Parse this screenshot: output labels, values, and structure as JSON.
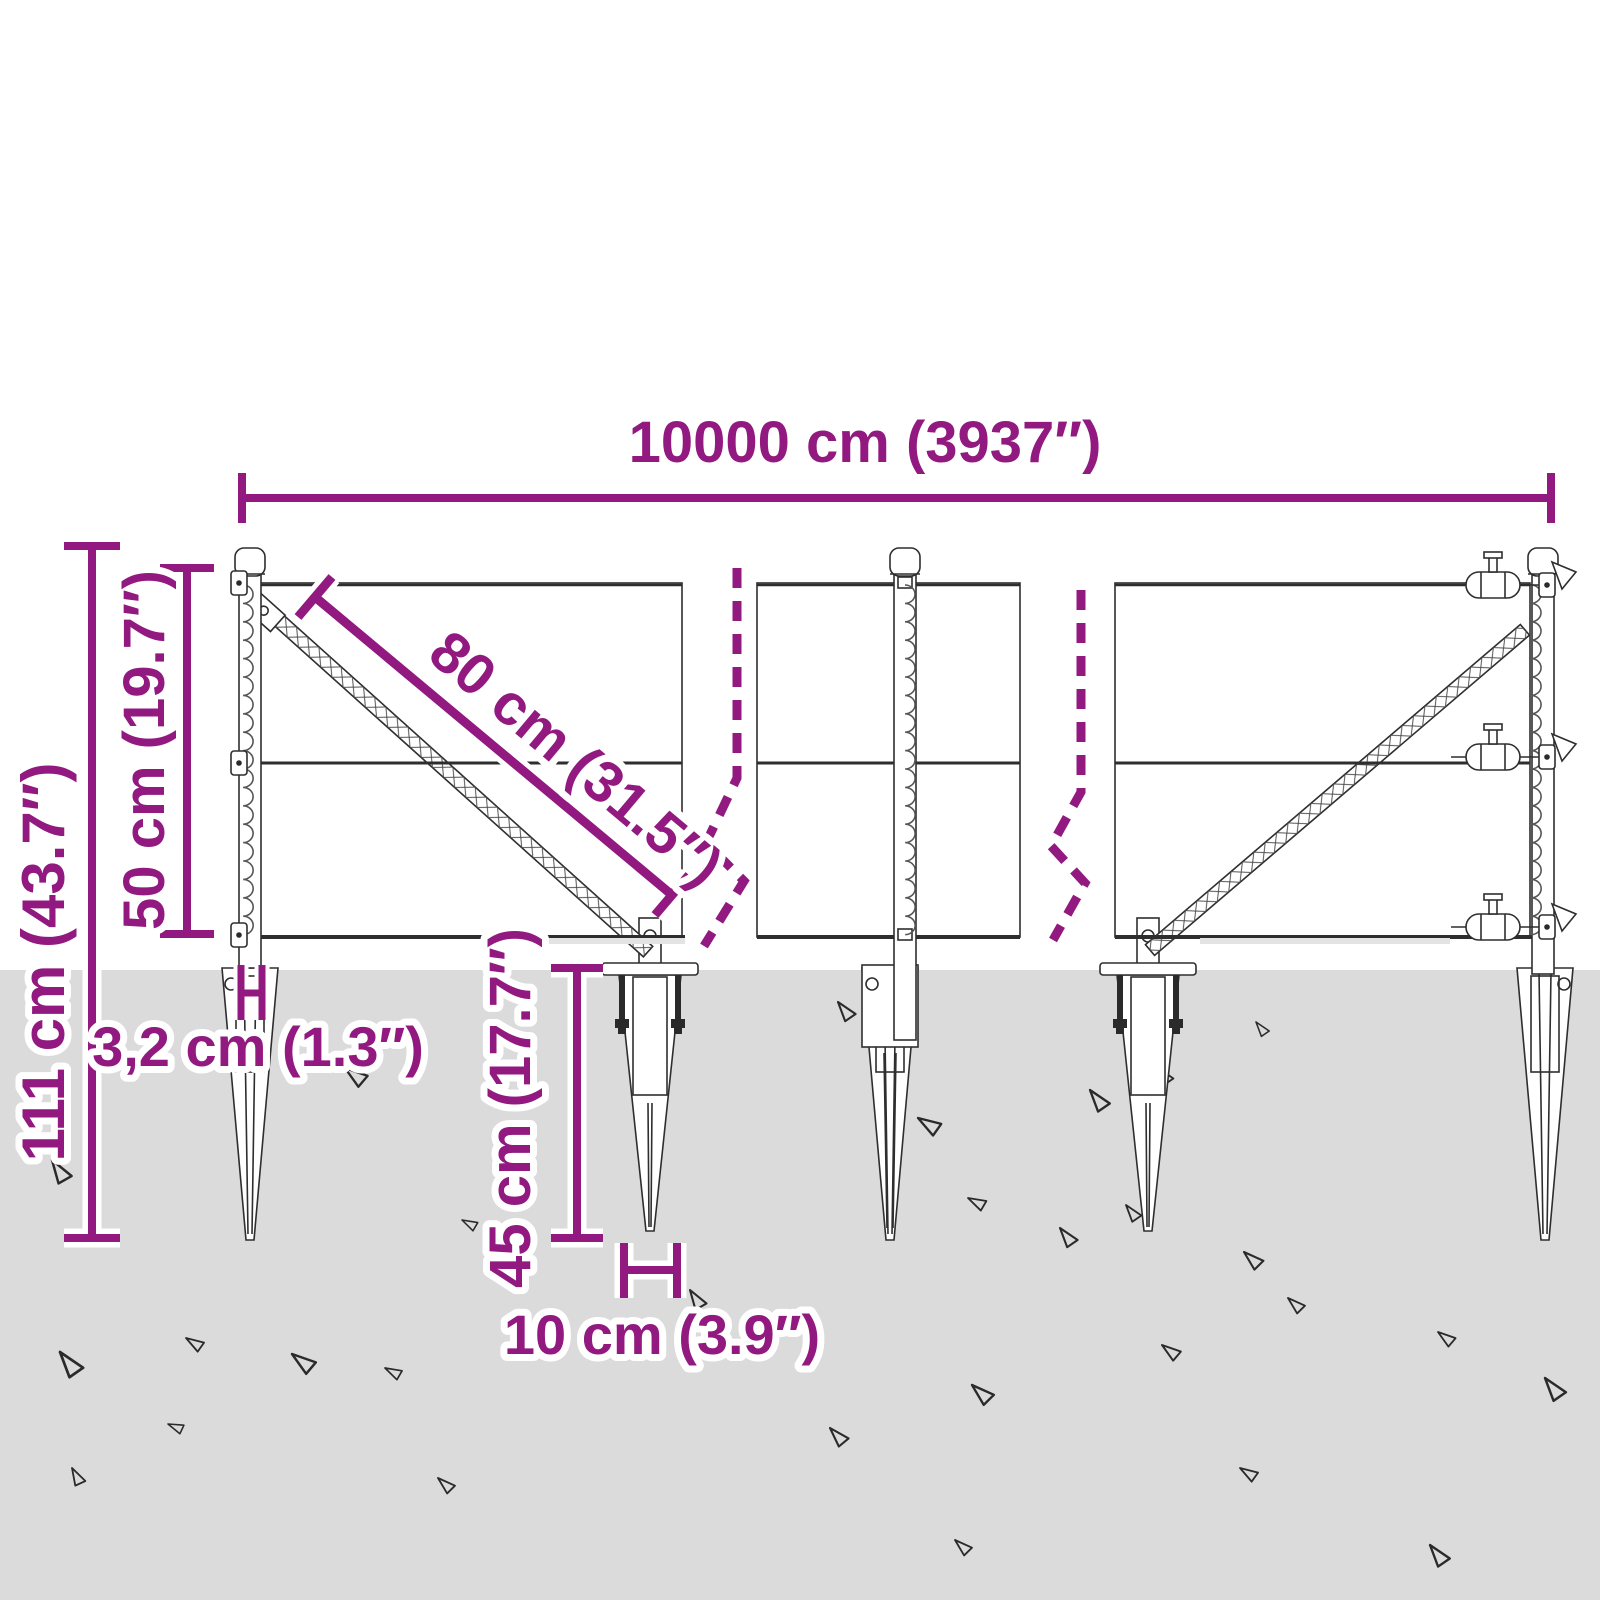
{
  "diagram": {
    "title": "Wire mesh fence with spike anchors - dimension drawing",
    "labels": {
      "total_width": "10000 cm (3937″)",
      "total_height": "111 cm (43.7″)",
      "mesh_height": "50 cm (19.7″)",
      "brace_length": "80 cm (31.5″)",
      "post_width": "3,2 cm (1.3″)",
      "spike_depth": "45 cm (17.7″)",
      "spike_top_width": "10 cm (3.9″)"
    },
    "colors": {
      "accent": "#911980",
      "ground": "#DBDBDB",
      "line": "#2E2E2E",
      "background": "#FFFFFF"
    }
  }
}
